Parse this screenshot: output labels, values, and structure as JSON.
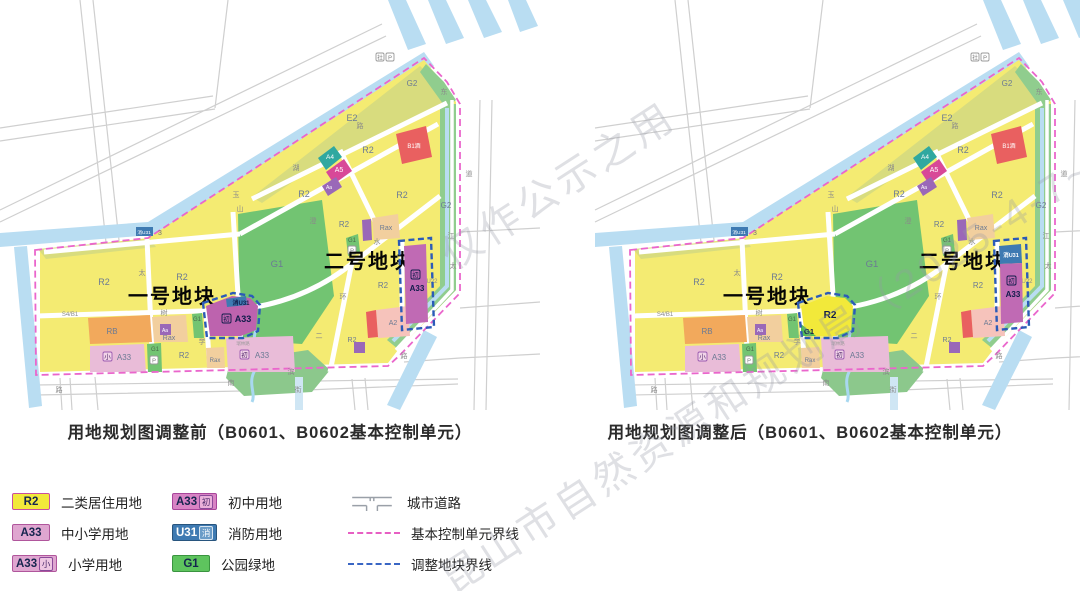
{
  "watermark": {
    "line1": "昆山市自然资源和规划局（2025-4-7~2025-5-",
    "line2": "仅作公示之用"
  },
  "captions": {
    "before": "用地规划图调整前（B0601、B0602基本控制单元）",
    "after": "用地规划图调整后（B0601、B0602基本控制单元）"
  },
  "legend": {
    "items": [
      {
        "id": "r2",
        "type": "swatch",
        "swatch": "R2",
        "fill": "#f2e93a",
        "border": "#c94f9e",
        "text_color": "#15254e",
        "label": "二类居住用地"
      },
      {
        "id": "a33",
        "type": "swatch",
        "swatch": "A33",
        "fill": "#dfa6d0",
        "border": "#b0569c",
        "text_color": "#15254e",
        "label": "中小学用地"
      },
      {
        "id": "a33-xiao",
        "type": "swatch",
        "swatch": "A33",
        "chip": "小",
        "chip_bg": "#eec6e2",
        "chip_border": "#8a4a9a",
        "chip_color": "#4a2a6a",
        "fill": "#dfa6d0",
        "border": "#b0569c",
        "text_color": "#15254e",
        "label": "小学用地"
      },
      {
        "id": "a33-chu",
        "type": "swatch",
        "swatch": "A33",
        "chip": "初",
        "chip_bg": "#eab0da",
        "chip_border": "#8a4a9a",
        "chip_color": "#4a2a6a",
        "fill": "#d883c4",
        "border": "#a8459a",
        "text_color": "#15254e",
        "label": "初中用地"
      },
      {
        "id": "u31",
        "type": "swatch",
        "swatch": "U31",
        "chip": "消",
        "chip_bg": "#6a9cc8",
        "chip_border": "#d8e6f2",
        "chip_color": "#ffffff",
        "fill": "#3e7ab2",
        "border": "#28557e",
        "text_color": "#ffffff",
        "label": "消防用地"
      },
      {
        "id": "g1",
        "type": "swatch",
        "swatch": "G1",
        "fill": "#5ec45e",
        "border": "#3a9440",
        "text_color": "#15254e",
        "label": "公园绿地"
      },
      {
        "id": "city-road",
        "type": "road",
        "label": "城市道路"
      },
      {
        "id": "unit-boundary",
        "type": "dash",
        "dash_color": "#e75fc3",
        "label": "基本控制单元界线"
      },
      {
        "id": "adjust-boundary",
        "type": "dash",
        "dash_color": "#3a66c4",
        "label": "调整地块界线"
      }
    ]
  },
  "map": {
    "shift_after": 55,
    "layers": [
      {
        "name": "outside-road-grid",
        "d": "M80,0 L117,345 M93,0 L130,342 M0,128 L213,96 M0,141 L215,109 M215,108 L228,0 M0,210 L382,24 M0,222 L386,36 M480,100 L474,410 M492,100 L486,410 M460,232 L540,228 M460,308 L540,302 M404,362 L460,358 M460,358 L540,354 M36,385 L458,379 M36,395 L294,390 M306,390 L458,384 M95,377 L98,410 M352,379 L355,410 M365,378 L368,410 M60,378 L62,410 M70,378 L72,410",
        "stroke": "#cfcfcf",
        "w": 1.2
      },
      {
        "name": "canal-stripes",
        "d": "M388,0 L406,0 L426,44 L408,50 Z M428,0 L446,0 L464,38 L446,44 Z M468,0 L486,0 L502,32 L484,38 Z M508,0 L526,0 L538,26 L520,32 Z",
        "fill": "#b9ddf2"
      },
      {
        "name": "river-west",
        "d": "M14,247 L27,246 L42,406 L29,408 Z",
        "fill": "#b9ddf2"
      },
      {
        "name": "river-main",
        "d": "M0,233 L148,222 L424,52 L434,66 L152,235 L0,247 Z",
        "fill": "#b9ddf2"
      },
      {
        "name": "residential-area-yellow",
        "d": "M40,250 L148,238 L424,60 L444,84 L456,102 L456,290 L398,350 L388,363 L40,372 Z",
        "fill": "#f4eb72"
      },
      {
        "name": "e2-block",
        "d": "M252,197 L420,66 L442,88 L448,102 L310,170 L262,203 Z",
        "fill": "#d8dc7e"
      },
      {
        "name": "olive-west-strip",
        "d": "M38,249 L150,239 L156,247 L46,259 Z",
        "fill": "#d8dc7e"
      },
      {
        "name": "g2-ne-wedge",
        "d": "M426,64 L444,82 L456,100 L446,108 L420,72 Z",
        "fill": "#90cd8e"
      },
      {
        "name": "g2-east-band",
        "d": "M440,104 L456,104 L456,290 L398,349 L387,340 L440,286 Z",
        "fill": "#90cd8e"
      },
      {
        "name": "east-road",
        "d": "M452,100 L452,290 L396,350",
        "stroke": "#ffffff",
        "w": 3.5
      },
      {
        "name": "east-river-line",
        "d": "M447,108 L447,286 L393,341",
        "stroke": "#b9ddf2",
        "w": 4
      },
      {
        "name": "g1-park-big",
        "d": "M238,214 L322,200 L334,296 L302,344 L240,340 Z",
        "fill": "#72c472"
      },
      {
        "name": "g1-marsh",
        "d": "M230,362 L308,350 L330,370 L312,392 L244,396 L226,378 Z",
        "fill": "#8cc88c"
      },
      {
        "name": "marsh-creek",
        "d": "M256,330 C250,345 262,356 254,372 C248,384 256,394 252,402",
        "stroke": "#a8d8f0",
        "w": 3
      },
      {
        "name": "river-bottom-right",
        "d": "M424,330 L437,337 L400,410 L387,405 Z",
        "fill": "#b9ddf2"
      },
      {
        "name": "canal-bottom-stub",
        "d": "M295,377 L303,377 L303,410 L295,410 Z",
        "fill": "#cfe6f4"
      },
      {
        "name": "inner-roads",
        "d": "M147,239 L153,372 M233,212 L241,345 M240,234 L438,124 M402,242 L402,330 M352,262 L330,372 M206,312 L210,372 M44,252 L240,234 M252,199 L447,103 M340,150 L384,240",
        "stroke": "#ffffff",
        "w": 5
      },
      {
        "name": "inner-road-curve",
        "d": "M36,316 L232,310 C282,306 322,288 354,262 L440,196",
        "stroke": "#ffffff",
        "w": 5
      },
      {
        "name": "rb-block",
        "d": "M88,318 L150,315 L152,342 L90,344 Z",
        "fill": "#f2a95c"
      },
      {
        "name": "rax-block-a",
        "d": "M152,317 L186,315 L188,342 L154,342 Z",
        "fill": "#f2cf9e"
      },
      {
        "name": "a33-primary-block",
        "d": "M90,346 L144,344 L146,372 L90,372 Z",
        "fill": "#e9bcd8"
      },
      {
        "name": "g1-strip-1",
        "d": "M147,344 L161,343 L162,372 L148,372 Z",
        "fill": "#72c472"
      },
      {
        "name": "rax-block-b",
        "d": "M206,348 L224,347 L225,368 L207,368 Z",
        "fill": "#f2cf9e"
      },
      {
        "name": "g1-strip-2",
        "d": "M192,314 L202,313 L204,338 L194,338 Z",
        "fill": "#72c472"
      },
      {
        "name": "a33-junior-pink-block",
        "d": "M226,338 L293,336 L295,372 L228,372 Z",
        "fill": "#e9bcd8"
      },
      {
        "name": "g1-strip-3",
        "d": "M346,238 L358,234 L360,252 L348,256 Z",
        "fill": "#72c472"
      },
      {
        "name": "a2-block",
        "d": "M376,310 L408,306 L410,336 L378,338 Z",
        "fill": "#f6c3bb"
      },
      {
        "name": "b1-tiny-block",
        "d": "M366,312 L376,310 L378,337 L368,338 Z",
        "fill": "#e96060"
      },
      {
        "name": "a4-block",
        "d": "M318,158 L334,146 L342,157 L326,170 Z",
        "fill": "#2fa8a0"
      },
      {
        "name": "a5-block",
        "d": "M326,172 L344,159 L352,171 L334,184 Z",
        "fill": "#d84898"
      },
      {
        "name": "aa-block-up",
        "d": "M322,186 L336,177 L342,187 L328,196 Z",
        "fill": "#9a68b8"
      },
      {
        "name": "b1-hotel-block",
        "d": "M396,134 L426,126 L432,157 L402,164 Z",
        "fill": "#e96060"
      },
      {
        "name": "rax-block-mid",
        "d": "M372,218 L398,214 L400,238 L374,240 Z",
        "fill": "#f2cf9e"
      },
      {
        "name": "aa-chip-mid",
        "d": "M362,220 L371,219 L372,240 L363,241 Z",
        "fill": "#9a68b8"
      },
      {
        "name": "aa-chip-1",
        "d": "M160,324 h11 v11 h-11 Z",
        "fill": "#9a68b8"
      },
      {
        "name": "aa-chip-2",
        "d": "M354,342 h11 v11 h-11 Z",
        "fill": "#9a68b8"
      },
      {
        "name": "u31-nw-chip",
        "d": "M136,227 h17 v9 h-17 Z",
        "fill": "#3e7ab2"
      },
      {
        "name": "unit-boundary-line",
        "d": "M35,250 L148,238 L424,58 L447,82 L460,104 L460,293 L400,355 L388,366 L36,375 Z",
        "stroke": "#ea66cc",
        "w": 1.8,
        "dash": "7,4"
      }
    ],
    "chips": [
      {
        "x": 150,
        "y": 356,
        "w": 8,
        "h": 8,
        "ch": "P",
        "style": "gray"
      },
      {
        "x": 348,
        "y": 246,
        "w": 8,
        "h": 8,
        "ch": "P",
        "style": "gray"
      },
      {
        "x": 376,
        "y": 53,
        "w": 8,
        "h": 8,
        "ch": "社",
        "style": "gray"
      },
      {
        "x": 386,
        "y": 53,
        "w": 8,
        "h": 8,
        "ch": "P",
        "style": "gray"
      },
      {
        "x": 103,
        "y": 352,
        "w": 9,
        "h": 9,
        "ch": "小",
        "style": "purple"
      },
      {
        "x": 240,
        "y": 350,
        "w": 9,
        "h": 9,
        "ch": "初",
        "style": "purple"
      }
    ],
    "labels": [
      {
        "t": "湖",
        "x": 296,
        "y": 170,
        "s": 7,
        "c": "#8a8a8a"
      },
      {
        "t": "澄",
        "x": 313,
        "y": 223,
        "s": 7,
        "c": "#8a8a8a"
      },
      {
        "t": "玉",
        "x": 236,
        "y": 197,
        "s": 7,
        "c": "#8a8a8a"
      },
      {
        "t": "山",
        "x": 240,
        "y": 211,
        "s": 7,
        "c": "#8a8a8a"
      },
      {
        "t": "太",
        "x": 142,
        "y": 275,
        "s": 7,
        "c": "#8a8a8a"
      },
      {
        "t": "树",
        "x": 164,
        "y": 315,
        "s": 7,
        "c": "#8a8a8a"
      },
      {
        "t": "学",
        "x": 202,
        "y": 344,
        "s": 7,
        "c": "#8a8a8a"
      },
      {
        "t": "水",
        "x": 377,
        "y": 244,
        "s": 7,
        "c": "#8a8a8a"
      },
      {
        "t": "环",
        "x": 343,
        "y": 299,
        "s": 7,
        "c": "#8a8a8a"
      },
      {
        "t": "二",
        "x": 319,
        "y": 338,
        "s": 7,
        "c": "#8a8a8a"
      },
      {
        "t": "南",
        "x": 231,
        "y": 385,
        "s": 7,
        "c": "#8a8a8a"
      },
      {
        "t": "滨",
        "x": 291,
        "y": 374,
        "s": 7,
        "c": "#8a8a8a"
      },
      {
        "t": "街",
        "x": 298,
        "y": 392,
        "s": 7,
        "c": "#8a8a8a"
      },
      {
        "t": "路",
        "x": 59,
        "y": 392,
        "s": 7,
        "c": "#8a8a8a"
      },
      {
        "t": "路",
        "x": 360,
        "y": 128,
        "s": 7,
        "c": "#8a8a8a"
      },
      {
        "t": "路",
        "x": 404,
        "y": 358,
        "s": 7,
        "c": "#8a8a8a"
      },
      {
        "t": "东",
        "x": 444,
        "y": 94,
        "s": 7,
        "c": "#8a8a8a"
      },
      {
        "t": "江",
        "x": 451,
        "y": 238,
        "s": 7,
        "c": "#8a8a8a"
      },
      {
        "t": "太",
        "x": 453,
        "y": 268,
        "s": 7,
        "c": "#8a8a8a"
      },
      {
        "t": "道",
        "x": 469,
        "y": 176,
        "s": 7,
        "c": "#8a8a8a"
      },
      {
        "t": "瑞林路",
        "x": 243,
        "y": 345,
        "s": 4.5,
        "c": "#9a9a9a"
      },
      {
        "t": "E2",
        "x": 352,
        "y": 121,
        "s": 9,
        "c": "#6b7a94"
      },
      {
        "t": "G2",
        "x": 412,
        "y": 86,
        "s": 8,
        "c": "#6b7a94"
      },
      {
        "t": "G2",
        "x": 446,
        "y": 208,
        "s": 8,
        "c": "#6b7a94"
      },
      {
        "t": "G1",
        "x": 277,
        "y": 267,
        "s": 9.5,
        "c": "#6b7a94"
      },
      {
        "t": "R2",
        "x": 104,
        "y": 285,
        "s": 9,
        "c": "#6b7a94"
      },
      {
        "t": "R2",
        "x": 182,
        "y": 280,
        "s": 9,
        "c": "#6b7a94"
      },
      {
        "t": "R2",
        "x": 304,
        "y": 197,
        "s": 9,
        "c": "#6b7a94"
      },
      {
        "t": "R2",
        "x": 368,
        "y": 153,
        "s": 9,
        "c": "#6b7a94"
      },
      {
        "t": "R2",
        "x": 402,
        "y": 198,
        "s": 9,
        "c": "#6b7a94"
      },
      {
        "t": "R2",
        "x": 344,
        "y": 227,
        "s": 8,
        "c": "#6b7a94"
      },
      {
        "t": "R2",
        "x": 383,
        "y": 288,
        "s": 8,
        "c": "#6b7a94"
      },
      {
        "t": "R2",
        "x": 184,
        "y": 358,
        "s": 8,
        "c": "#6b7a94"
      },
      {
        "t": "R2",
        "x": 352,
        "y": 342,
        "s": 7,
        "c": "#6b7a94"
      },
      {
        "t": "RB",
        "x": 112,
        "y": 334,
        "s": 8,
        "c": "#6b7a94"
      },
      {
        "t": "Rax",
        "x": 169,
        "y": 340,
        "s": 7,
        "c": "#6b7a94"
      },
      {
        "t": "Rax",
        "x": 386,
        "y": 230,
        "s": 7,
        "c": "#6b7a94"
      },
      {
        "t": "Rax",
        "x": 215,
        "y": 362,
        "s": 6,
        "c": "#6b7a94"
      },
      {
        "t": "A2",
        "x": 393,
        "y": 325,
        "s": 7,
        "c": "#6b7a94"
      },
      {
        "t": "U22",
        "x": 432,
        "y": 283,
        "s": 6,
        "c": "#8a8a8a"
      },
      {
        "t": "S4/B1",
        "x": 70,
        "y": 316,
        "s": 6,
        "c": "#8a8a8a"
      },
      {
        "t": "G1",
        "x": 155,
        "y": 351,
        "s": 6,
        "c": "#4a6a4a"
      },
      {
        "t": "G1",
        "x": 197,
        "y": 321,
        "s": 6,
        "c": "#4a6a4a"
      },
      {
        "t": "G1",
        "x": 352,
        "y": 242,
        "s": 6,
        "c": "#4a6a4a"
      },
      {
        "t": "A33",
        "x": 124,
        "y": 360,
        "s": 8,
        "c": "#6b7a94"
      },
      {
        "t": "A33",
        "x": 262,
        "y": 358,
        "s": 8,
        "c": "#6b7a94"
      },
      {
        "t": "A4",
        "x": 330,
        "y": 159,
        "s": 6.5,
        "c": "#ffffff"
      },
      {
        "t": "A5",
        "x": 339,
        "y": 172,
        "s": 7,
        "c": "#ffffff"
      },
      {
        "t": "B1酒",
        "x": 414,
        "y": 148,
        "s": 6,
        "c": "#ffffff"
      },
      {
        "t": "Aa",
        "x": 165,
        "y": 332,
        "s": 5,
        "c": "#ffffff"
      },
      {
        "t": "Aa",
        "x": 329,
        "y": 189,
        "s": 5,
        "c": "#ffffff"
      },
      {
        "t": "消U31",
        "x": 144,
        "y": 234,
        "s": 4.8,
        "c": "#ffffff"
      },
      {
        "t": "3",
        "x": 160,
        "y": 235,
        "s": 7,
        "c": "#777777"
      },
      {
        "t": "一号地块",
        "x": 172,
        "y": 303,
        "s": 20,
        "c": "#050505",
        "b": 1,
        "ls": 2
      },
      {
        "t": "二号地块",
        "x": 368,
        "y": 268,
        "s": 20,
        "c": "#050505",
        "b": 1,
        "ls": 2
      }
    ],
    "plots": {
      "before": {
        "layers": [
          {
            "name": "plot1-fill",
            "d": "M206,306 L232,296 L250,298 L258,306 L256,330 L241,336 L210,336 Z",
            "fill": "#bd63ae"
          },
          {
            "name": "plot1-u31-sliver",
            "d": "M226,299 L246,296 L247,305 L227,307 Z",
            "fill": "#3e7ab2"
          },
          {
            "name": "plot2-fill",
            "d": "M404,246 L426,244 L428,322 L406,324 Z",
            "fill": "#c06ab4"
          },
          {
            "name": "plot1-adjust-border",
            "d": "M203,303 L233,293 L252,296 L260,305 L258,331 L243,338 L207,338 Z",
            "stroke": "#2b5bb8",
            "w": 2.4,
            "dash": "6,3.5"
          },
          {
            "name": "plot2-adjust-border",
            "d": "M399,241 L431,238 L434,327 L402,330 Z",
            "stroke": "#2b5bb8",
            "w": 2.4,
            "dash": "6,3.5"
          }
        ],
        "chips": [
          {
            "x": 222,
            "y": 314,
            "w": 9,
            "h": 9,
            "ch": "初",
            "style": "navy"
          },
          {
            "x": 411,
            "y": 270,
            "w": 9,
            "h": 9,
            "ch": "初",
            "style": "navy"
          }
        ],
        "labels": [
          {
            "t": "消U31",
            "x": 241,
            "y": 305,
            "s": 6,
            "c": "#101c4a",
            "b": 1
          },
          {
            "t": "A33",
            "x": 243,
            "y": 322,
            "s": 9,
            "c": "#101c4a",
            "b": 1
          },
          {
            "t": "A33",
            "x": 417,
            "y": 291,
            "s": 8,
            "c": "#101c4a",
            "b": 1
          }
        ]
      },
      "after": {
        "layers": [
          {
            "name": "plot1-fill",
            "d": "M206,306 L232,296 L250,298 L258,306 L256,330 L241,336 L210,336 Z",
            "fill": "#f2e93a"
          },
          {
            "name": "plot1-g1-corner",
            "d": "M206,324 L221,336 L206,336 Z",
            "fill": "#54bc54"
          },
          {
            "name": "plot2-u31-top",
            "d": "M404,246 L426,244 L427,263 L405,264 Z",
            "fill": "#3e7ab2"
          },
          {
            "name": "plot2-fill",
            "d": "M405,264 L427,263 L428,322 L406,324 Z",
            "fill": "#c06ab4"
          },
          {
            "name": "plot1-adjust-border",
            "d": "M203,303 L233,293 L252,296 L260,305 L258,331 L243,338 L207,338 Z",
            "stroke": "#2b5bb8",
            "w": 2.4,
            "dash": "6,3.5"
          },
          {
            "name": "plot2-adjust-border",
            "d": "M399,241 L431,238 L434,327 L402,330 Z",
            "stroke": "#2b5bb8",
            "w": 2.4,
            "dash": "6,3.5"
          }
        ],
        "chips": [
          {
            "x": 412,
            "y": 276,
            "w": 9,
            "h": 9,
            "ch": "初",
            "style": "navy"
          }
        ],
        "labels": [
          {
            "t": "R2",
            "x": 235,
            "y": 318,
            "s": 10,
            "c": "#101c4a",
            "b": 1
          },
          {
            "t": "G1",
            "x": 214,
            "y": 334,
            "s": 7.5,
            "c": "#101c4a",
            "b": 1
          },
          {
            "t": "消U31",
            "x": 416,
            "y": 257,
            "s": 5.5,
            "c": "#ffffff",
            "b": 1
          },
          {
            "t": "A33",
            "x": 418,
            "y": 297,
            "s": 8,
            "c": "#101c4a",
            "b": 1
          }
        ]
      }
    }
  }
}
